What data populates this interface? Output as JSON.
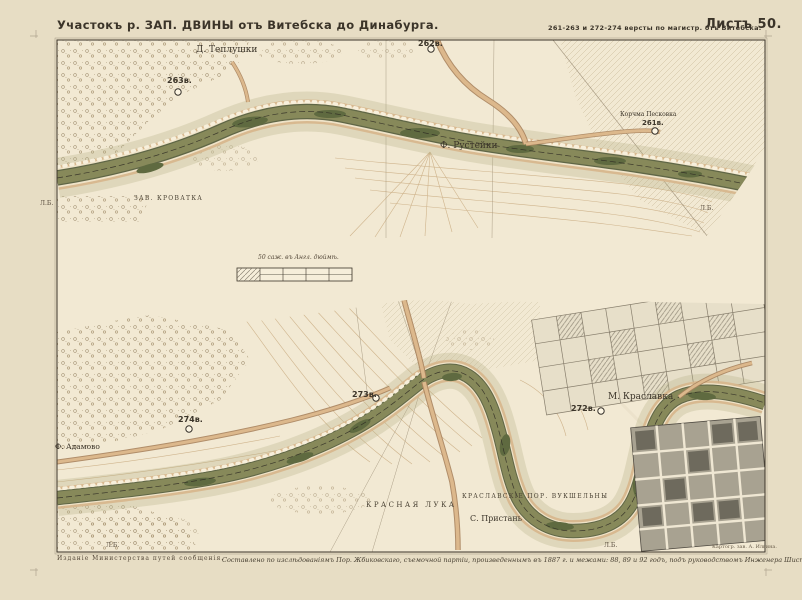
{
  "sheet_meta": {
    "title": "Участокъ р. ЗАП. ДВИНЫ отъ Витебска до Динабурга.",
    "route_versts": "261-263 и 272-274 версты по магистр. отъ Витебска.",
    "sheet_no": "Листъ 50."
  },
  "upper_map": {
    "village": "Д. Теплушки",
    "verst_263": "263в.",
    "verst_262": "262в.",
    "verst_261": "261в.",
    "tavern": "Корчма Песковка",
    "farm": "Ф. Рустейки",
    "feature": "ЗАВ. КРОВАТКА",
    "bank_left": "Л.Б.",
    "bank_right": "Л.Б."
  },
  "scale_bar": {
    "label": "50 саж. въ Англ. дюймѣ."
  },
  "lower_map": {
    "verst_274": "274в.",
    "verst_273": "273в.",
    "verst_272": "272в.",
    "town": "М. Краславка",
    "farm": "Ф. Адамово",
    "bend": "КРАСНАЯ ЛУКА",
    "rapids": "КРАСЛАВСКІЕ ПОР. ВУКШЕЛЬНЫ",
    "pier": "С. Пристань",
    "bank_left": "Л.Б.",
    "bank_right": "Л.Б."
  },
  "footer": {
    "publisher": "Изданіе Министерства путей сообщенія.",
    "credit": "Составлено по изслѣдованіямъ Пор. Жбиковскаго, съемочной партіи, произведеннымъ въ 1887 г. и межами: 88, 89 и 92 годъ, подъ руководствомъ Инженера Шистовскаго.",
    "printer": "Картогр. зав. А. Ильина."
  },
  "colors": {
    "paper": "#e7ddc4",
    "panel": "#f2e9d3",
    "river": "#87895a",
    "river_dark": "#4f5837",
    "bank_tan": "#d7b68c",
    "contour": "#c9ab80",
    "ink": "#3b3429",
    "town_block": "#a8a291"
  }
}
